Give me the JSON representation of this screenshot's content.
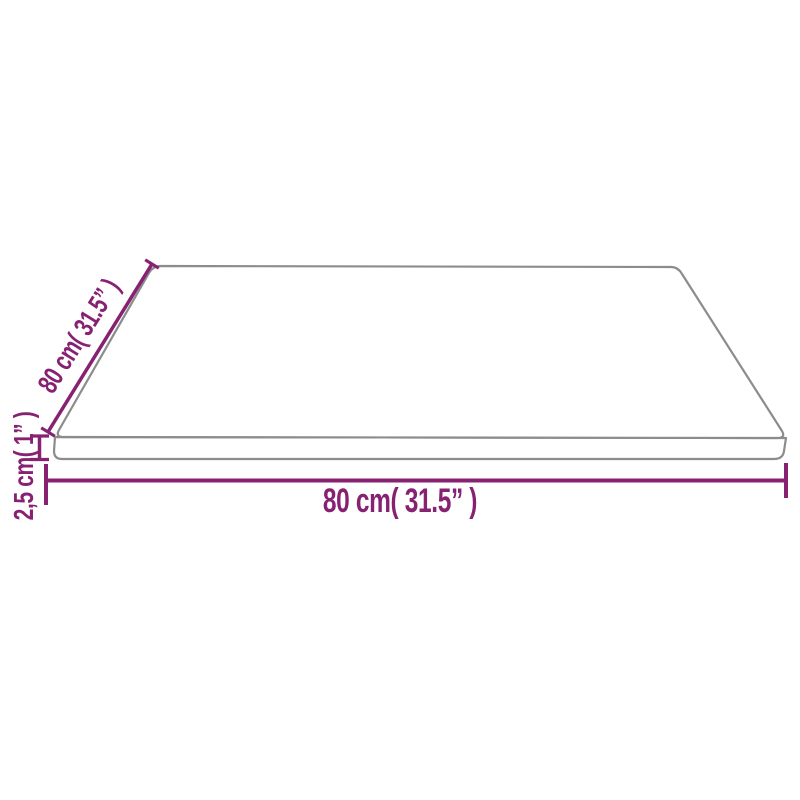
{
  "diagram": {
    "type": "product-dimension-drawing",
    "labels": {
      "width": "80 cm( 31.5” )",
      "depth": "80 cm( 31.5” )",
      "thickness": "2,5 cm( 1” )"
    },
    "colors": {
      "dimension_accent": "#872273",
      "outline_gray": "#8c8c8c",
      "background": "#ffffff"
    }
  }
}
